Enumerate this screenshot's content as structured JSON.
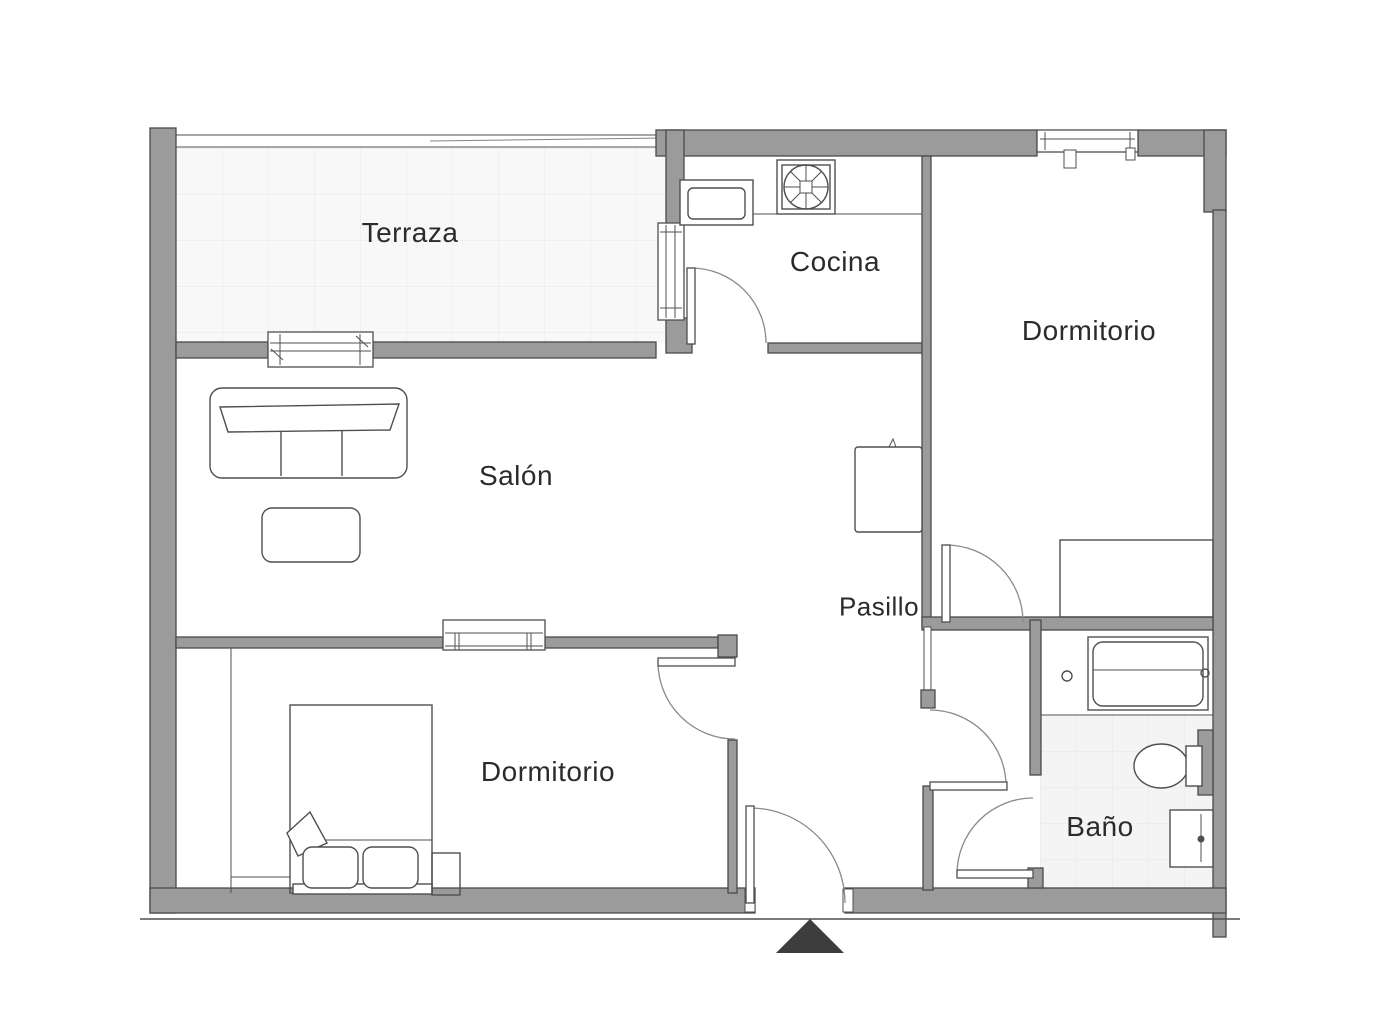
{
  "floor_plan": {
    "rooms": [
      {
        "id": "terraza",
        "label": "Terraza"
      },
      {
        "id": "cocina",
        "label": "Cocina"
      },
      {
        "id": "dormitorio-principal",
        "label": "Dormitorio"
      },
      {
        "id": "salon",
        "label": "Salón"
      },
      {
        "id": "pasillo",
        "label": "Pasillo"
      },
      {
        "id": "dormitorio-secundario",
        "label": "Dormitorio"
      },
      {
        "id": "bano",
        "label": "Baño"
      }
    ],
    "furniture": [
      "sofa",
      "coffee-table",
      "cabinet",
      "kitchen-sink",
      "cooktop",
      "kitchen-counter",
      "double-bed",
      "pillow",
      "nightstand",
      "wardrobe",
      "dresser",
      "bathtub",
      "toilet",
      "washbasin"
    ],
    "entrance": {
      "marker": "triangle",
      "position": "bottom"
    },
    "colors": {
      "background": "#ffffff",
      "wall_fill": "#9b9b9b",
      "wall_stroke": "#4a4a4a",
      "line_color": "#4f4f4f",
      "arc_color": "#8a8a8a",
      "terrace_tile_fill": "#f8f8f8",
      "terrace_tile_line": "#e8e8e8",
      "bath_tile_fill": "#f4f4f4",
      "bath_tile_line": "#e6e6e6",
      "label_color": "#2b2b2b",
      "entrance_marker": "#3d3d3d"
    }
  }
}
